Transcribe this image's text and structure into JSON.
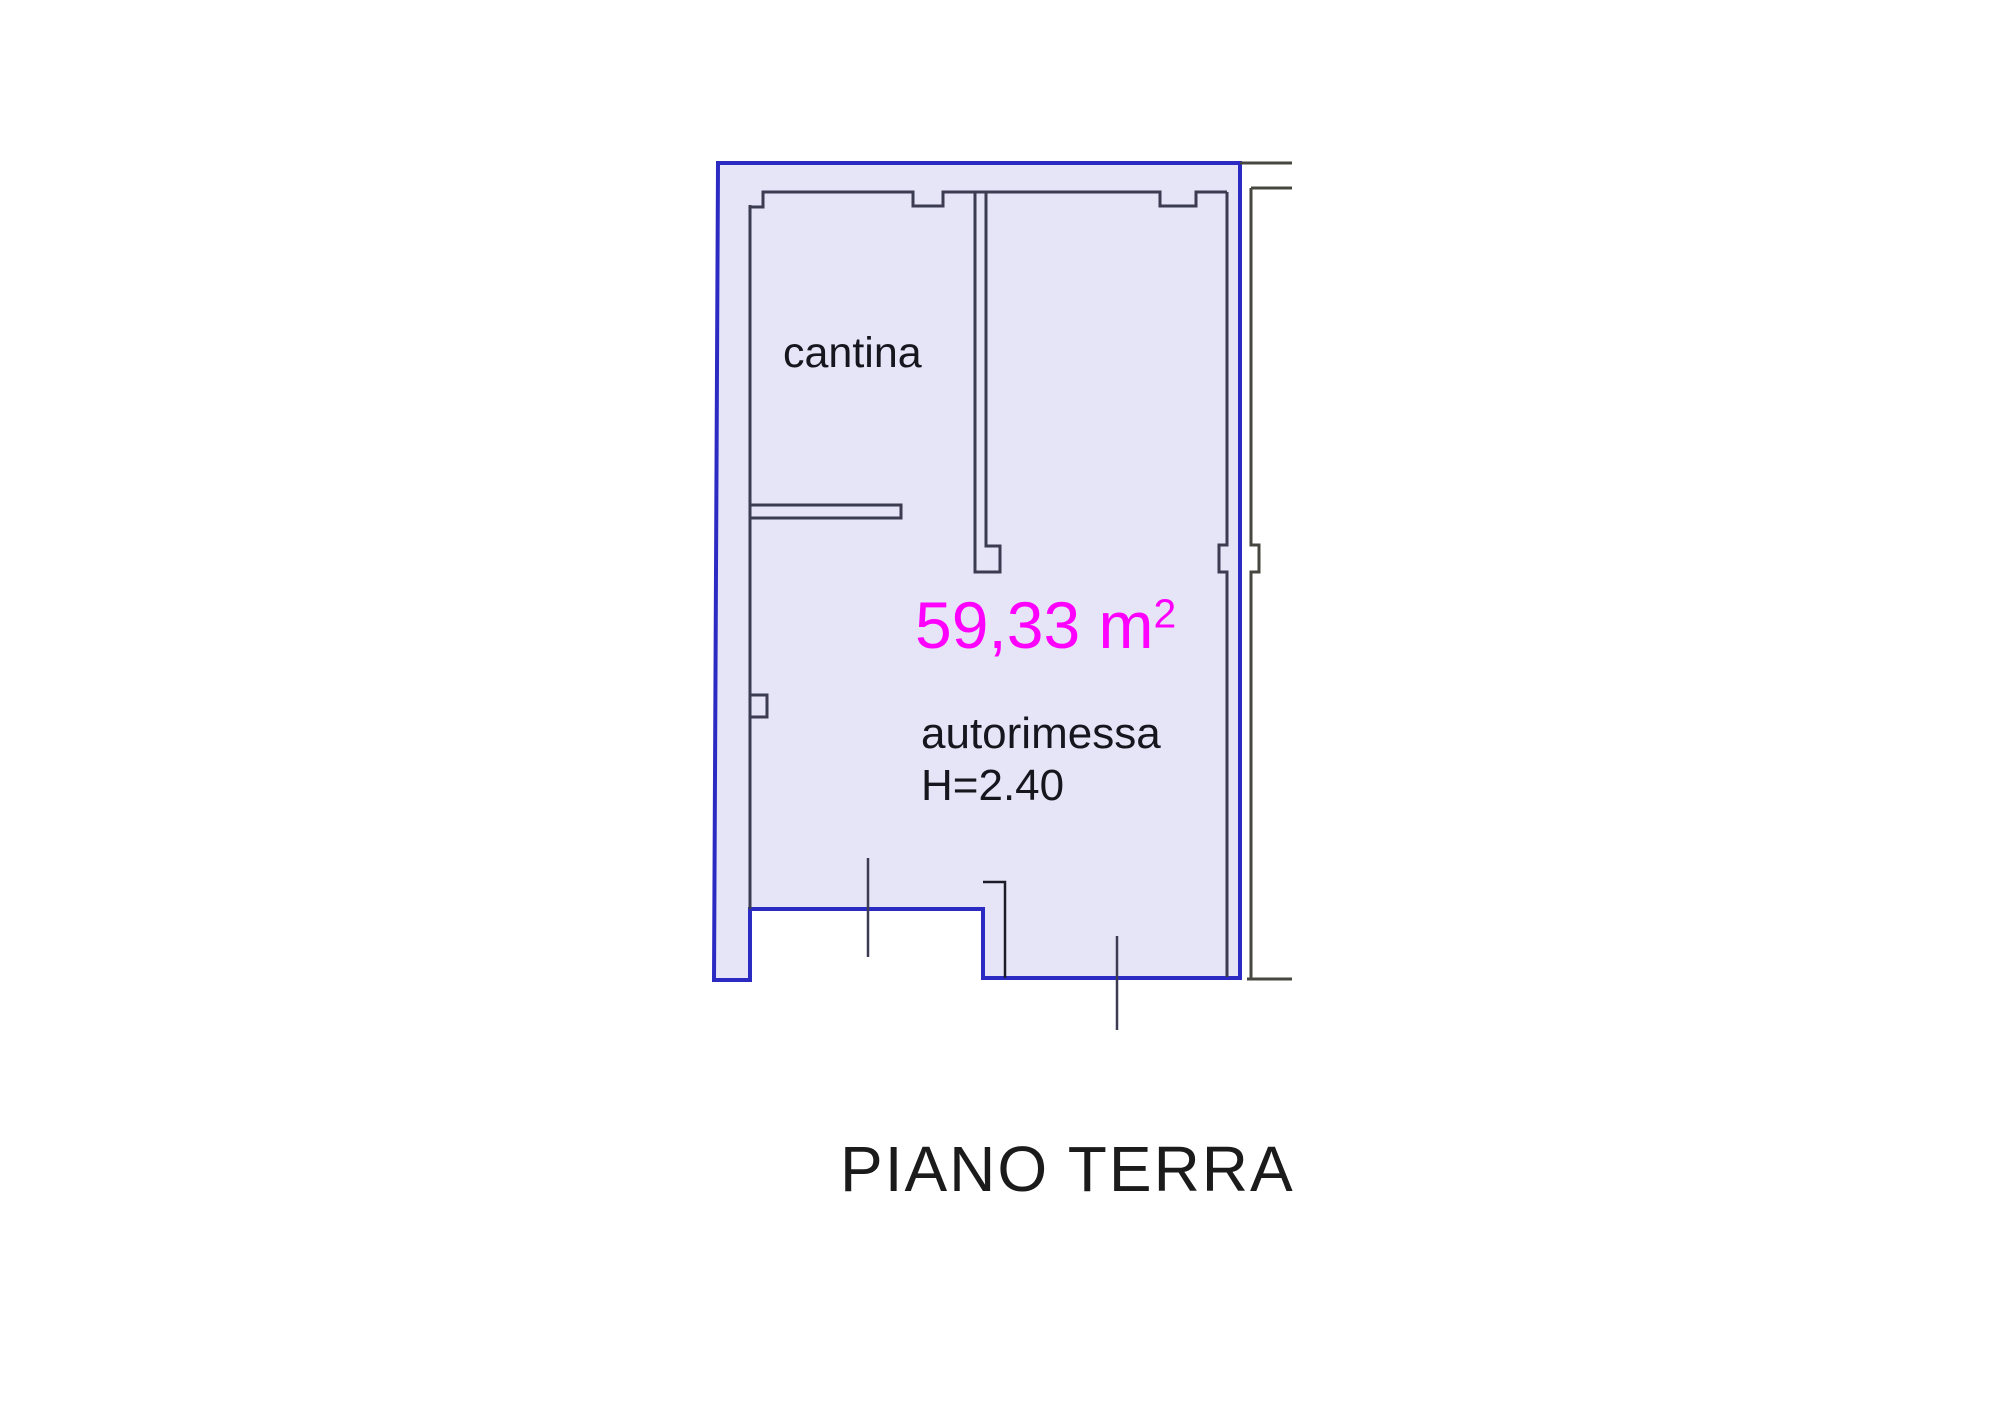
{
  "floor_plan": {
    "labels": {
      "room1": "cantina",
      "area_value": "59,33 m",
      "area_sup": "2",
      "room2": "autorimessa",
      "height": "H=2.40"
    },
    "title": "PIANO TERRA",
    "colors": {
      "wall-blue": "#2B2BC4",
      "plan-fill": "#E6E5F7",
      "inner-line": "#3B3B52",
      "outer-line": "#47473F",
      "area-magenta": "#FF00FF",
      "label-dark": "#16161F",
      "title-black": "#1B1B1B"
    }
  }
}
